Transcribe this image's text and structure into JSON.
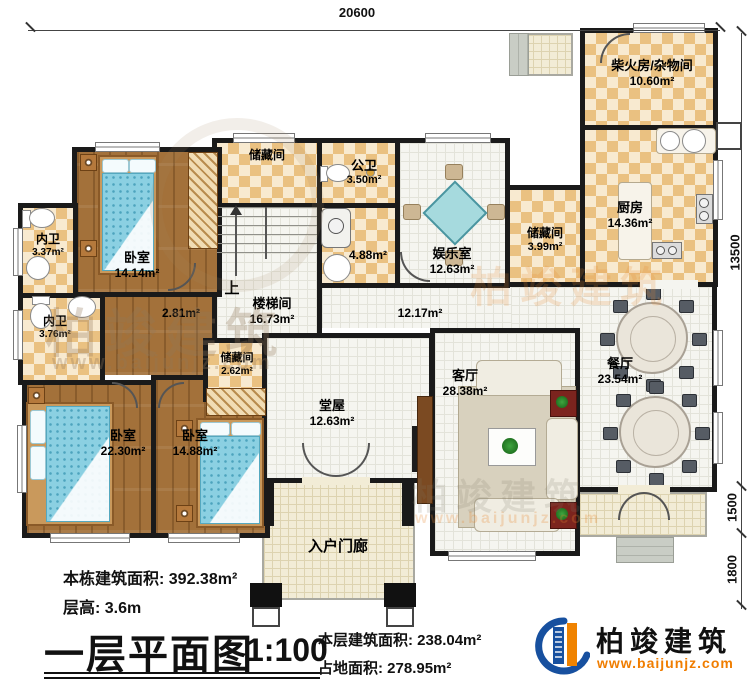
{
  "plan": {
    "dims": {
      "top": "20600",
      "right_main": "13500",
      "right_mid": "1500",
      "right_low": "1800"
    },
    "stairs_up": "上",
    "rooms": {
      "chaihuo": {
        "name": "柴火房/杂物间",
        "area": "10.60m²"
      },
      "kitchen": {
        "name": "厨房",
        "area": "14.36m²"
      },
      "storage_right": {
        "name": "储藏间",
        "area": "3.99m²"
      },
      "dining": {
        "name": "餐厅",
        "area": "23.54m²"
      },
      "storage_top": {
        "name": "储藏间"
      },
      "public_bath": {
        "name": "公卫",
        "area": "3.50m²"
      },
      "wash": {
        "area": "4.88m²"
      },
      "entertainment": {
        "name": "娱乐室",
        "area": "12.63m²"
      },
      "stairwell": {
        "name": "楼梯间",
        "area": "16.73m²"
      },
      "hall": {
        "area": "2.81m²"
      },
      "corridor": {
        "area": "12.17m²"
      },
      "living": {
        "name": "客厅",
        "area": "28.38m²"
      },
      "tangwu": {
        "name": "堂屋",
        "area": "12.63m²"
      },
      "porch": {
        "name": "入户门廊"
      },
      "bath1": {
        "name": "内卫",
        "area": "3.37m²"
      },
      "bedroom1": {
        "name": "卧室",
        "area": "14.14m²"
      },
      "bath2": {
        "name": "内卫",
        "area": "3.76m²"
      },
      "storage_small": {
        "name": "储藏间",
        "area": "2.62m²"
      },
      "bedroom2": {
        "name": "卧室",
        "area": "22.30m²"
      },
      "bedroom3": {
        "name": "卧室",
        "area": "14.88m²"
      }
    }
  },
  "footer": {
    "total_area": "本栋建筑面积: 392.38m²",
    "floor_height": "层高: 3.6m",
    "title": "一层平面图",
    "scale": "1:100",
    "floor_area": "本层建筑面积: 238.04m²",
    "footprint": "占地面积: 278.95m²"
  },
  "brand": {
    "name": "柏竣建筑",
    "url": "www.baijunjz.com"
  },
  "watermark": {
    "text": "柏竣建筑",
    "url": "www.baijunjz.com"
  },
  "colors": {
    "wall": "#1a1a1a",
    "accent_orange": "#f08300",
    "brand_blue": "#17509f"
  }
}
